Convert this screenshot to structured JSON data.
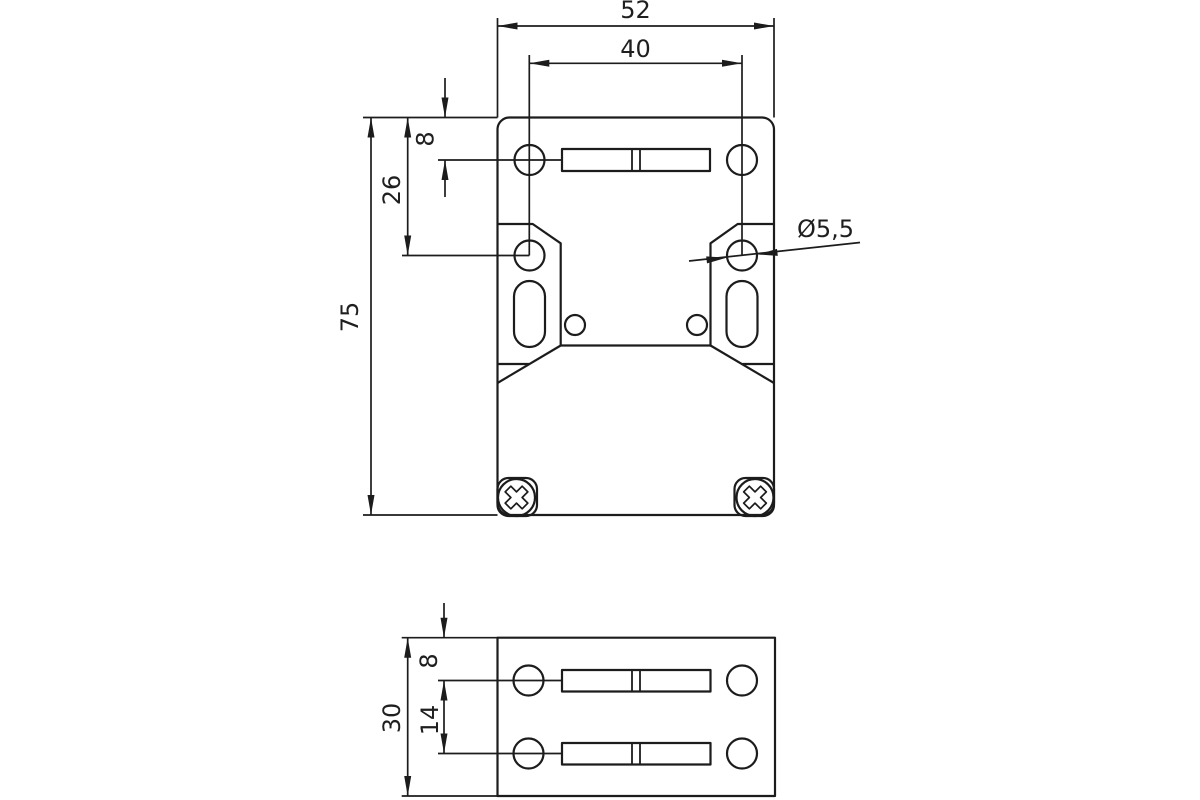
{
  "drawing": {
    "title": "safety-switch-housing-dimension-drawing",
    "line_color": "#1c1c1c",
    "background": "#ffffff",
    "views": [
      {
        "id": "front",
        "description": "front view of housing with mounting holes, slots and two screws"
      },
      {
        "id": "side",
        "description": "bottom/side view of mounting flange with two hole rows"
      }
    ]
  },
  "dimensions": {
    "front_view": {
      "overall_width": "52",
      "hole_pitch_horizontal": "40",
      "row1_offset_from_top": "8",
      "row2_offset_from_top": "26",
      "overall_height": "75",
      "hole_diameter": "Ø5,5"
    },
    "side_view": {
      "row1_offset_from_top": "8",
      "row_pitch": "14",
      "overall_depth": "30"
    }
  }
}
